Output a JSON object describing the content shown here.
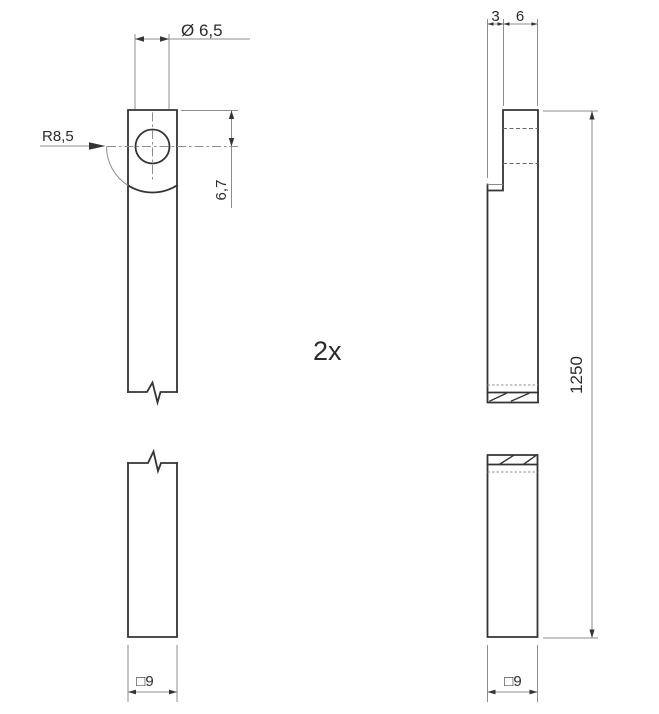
{
  "drawing": {
    "annotations": {
      "quantity": "2x",
      "hole_diameter": "Ø 6,5",
      "radius": "R8,5",
      "hole_offset": "6,7",
      "step_width": "3",
      "tab_thickness": "6",
      "overall_length": "1250",
      "square_section_front": "□9",
      "square_section_side": "□9"
    },
    "colors": {
      "background": "#ffffff",
      "outline": "#343434",
      "thin_line": "#8c8c8c",
      "hidden_line": "#6a6a6a",
      "text": "#2b2b2b"
    }
  }
}
